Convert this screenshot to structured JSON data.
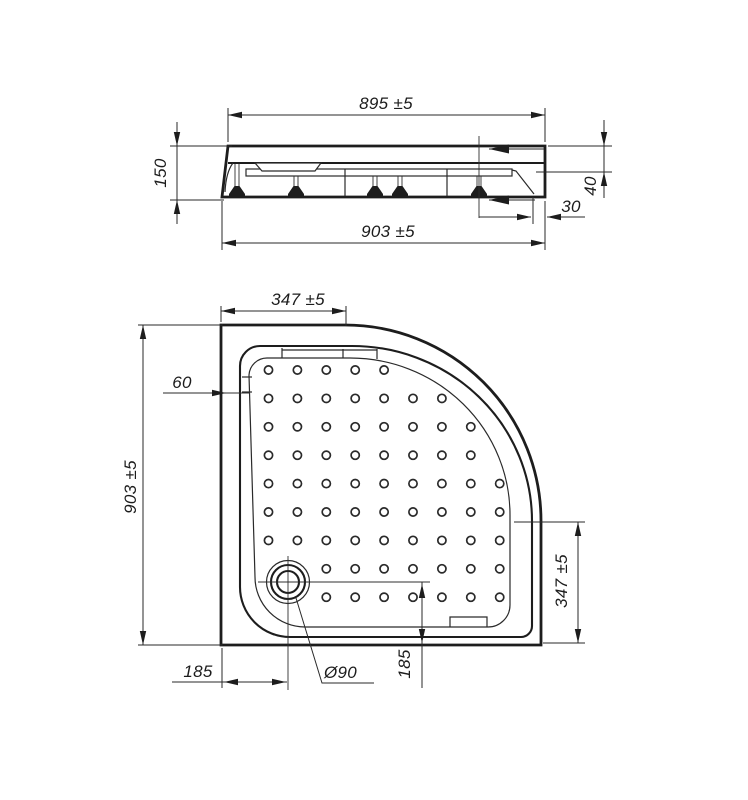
{
  "drawing": {
    "title": "Quarter-round shower tray dimension drawing",
    "colors": {
      "line": "#1d1d1d",
      "background": "#ffffff"
    },
    "side_view": {
      "name": "side-elevation",
      "dims": {
        "top_width": "895 ±5",
        "height": "150",
        "bottom_width": "903 ±5",
        "apron_height": "40",
        "panel_offset": "30"
      }
    },
    "plan_view": {
      "name": "plan-view",
      "dims": {
        "corner_edge_top": "347 ±5",
        "rim_width": "60",
        "side_length": "903 ±5",
        "corner_edge_right": "347 ±5",
        "drain_offset_x": "185",
        "drain_offset_y": "185",
        "drain_diameter": "Ø90"
      }
    },
    "dots_grid": {
      "x0": 268.5,
      "y0": 370,
      "dx": 28.9,
      "dy": 28.4,
      "r": 4.1,
      "rows": [
        {
          "start": 0,
          "count": 5
        },
        {
          "start": 0,
          "count": 7
        },
        {
          "start": 0,
          "count": 8
        },
        {
          "start": 0,
          "count": 8
        },
        {
          "start": 0,
          "count": 9
        },
        {
          "start": 0,
          "count": 9
        },
        {
          "start": 0,
          "count": 9
        },
        {
          "start": 2,
          "count": 7
        },
        {
          "start": 2,
          "count": 7
        }
      ]
    }
  }
}
